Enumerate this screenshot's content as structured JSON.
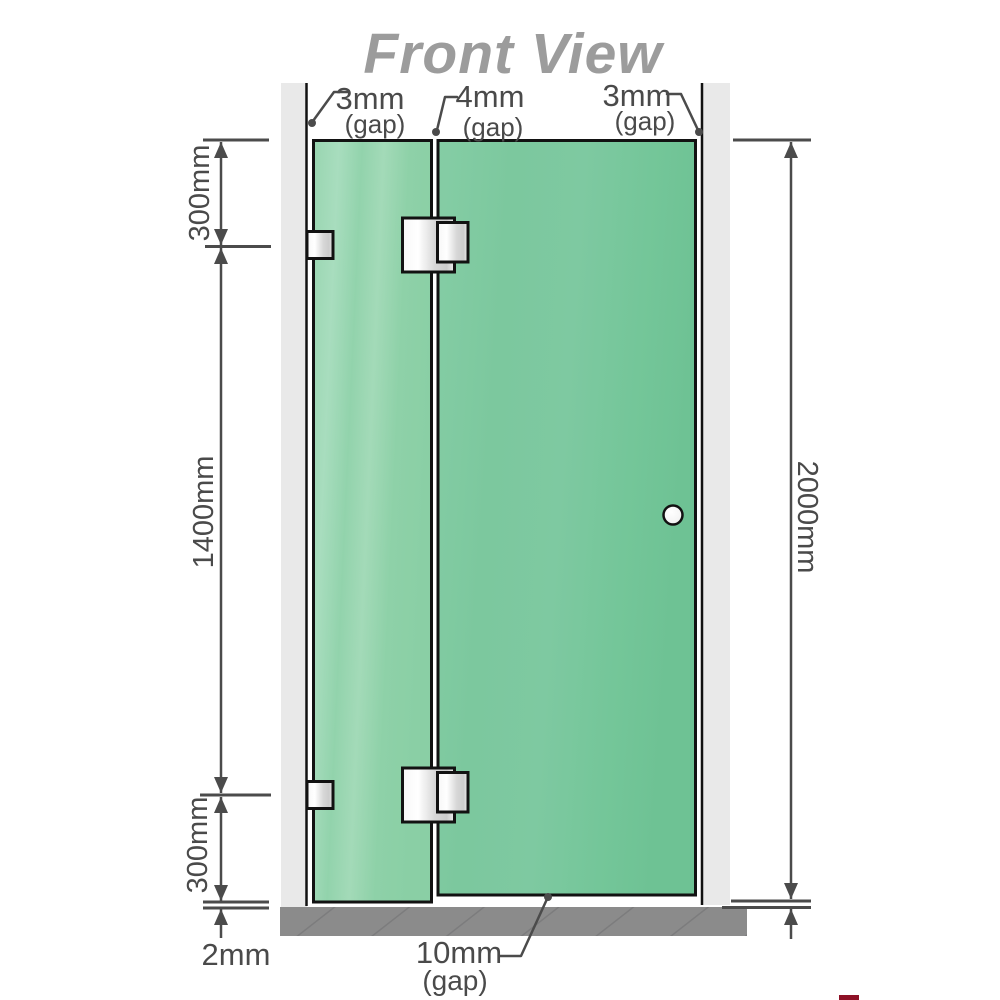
{
  "title": "Front View",
  "colors": {
    "glass_green_door": "#7cc8a0",
    "glass_green_fixed_light": "#a6dcbb",
    "wall_gray": "#e9e9e9",
    "floor_gray": "#8b8b8b",
    "dimension_gray": "#4b4b4b",
    "title_gray": "#9c9c9c",
    "hardware_silver": "#e0e0e0",
    "outline_black": "#121212"
  },
  "top_gap_labels": [
    {
      "value": "3mm",
      "suffix": "(gap)"
    },
    {
      "value": "4mm",
      "suffix": "(gap)"
    },
    {
      "value": "3mm",
      "suffix": "(gap)"
    }
  ],
  "left_dimensions": {
    "top": "300mm",
    "middle": "1400mm",
    "bottom": "300mm"
  },
  "right_dimension": "2000mm",
  "bottom_dimensions": {
    "floor_clearance": "2mm",
    "door_floor_gap": {
      "value": "10mm",
      "suffix": "(gap)"
    }
  }
}
